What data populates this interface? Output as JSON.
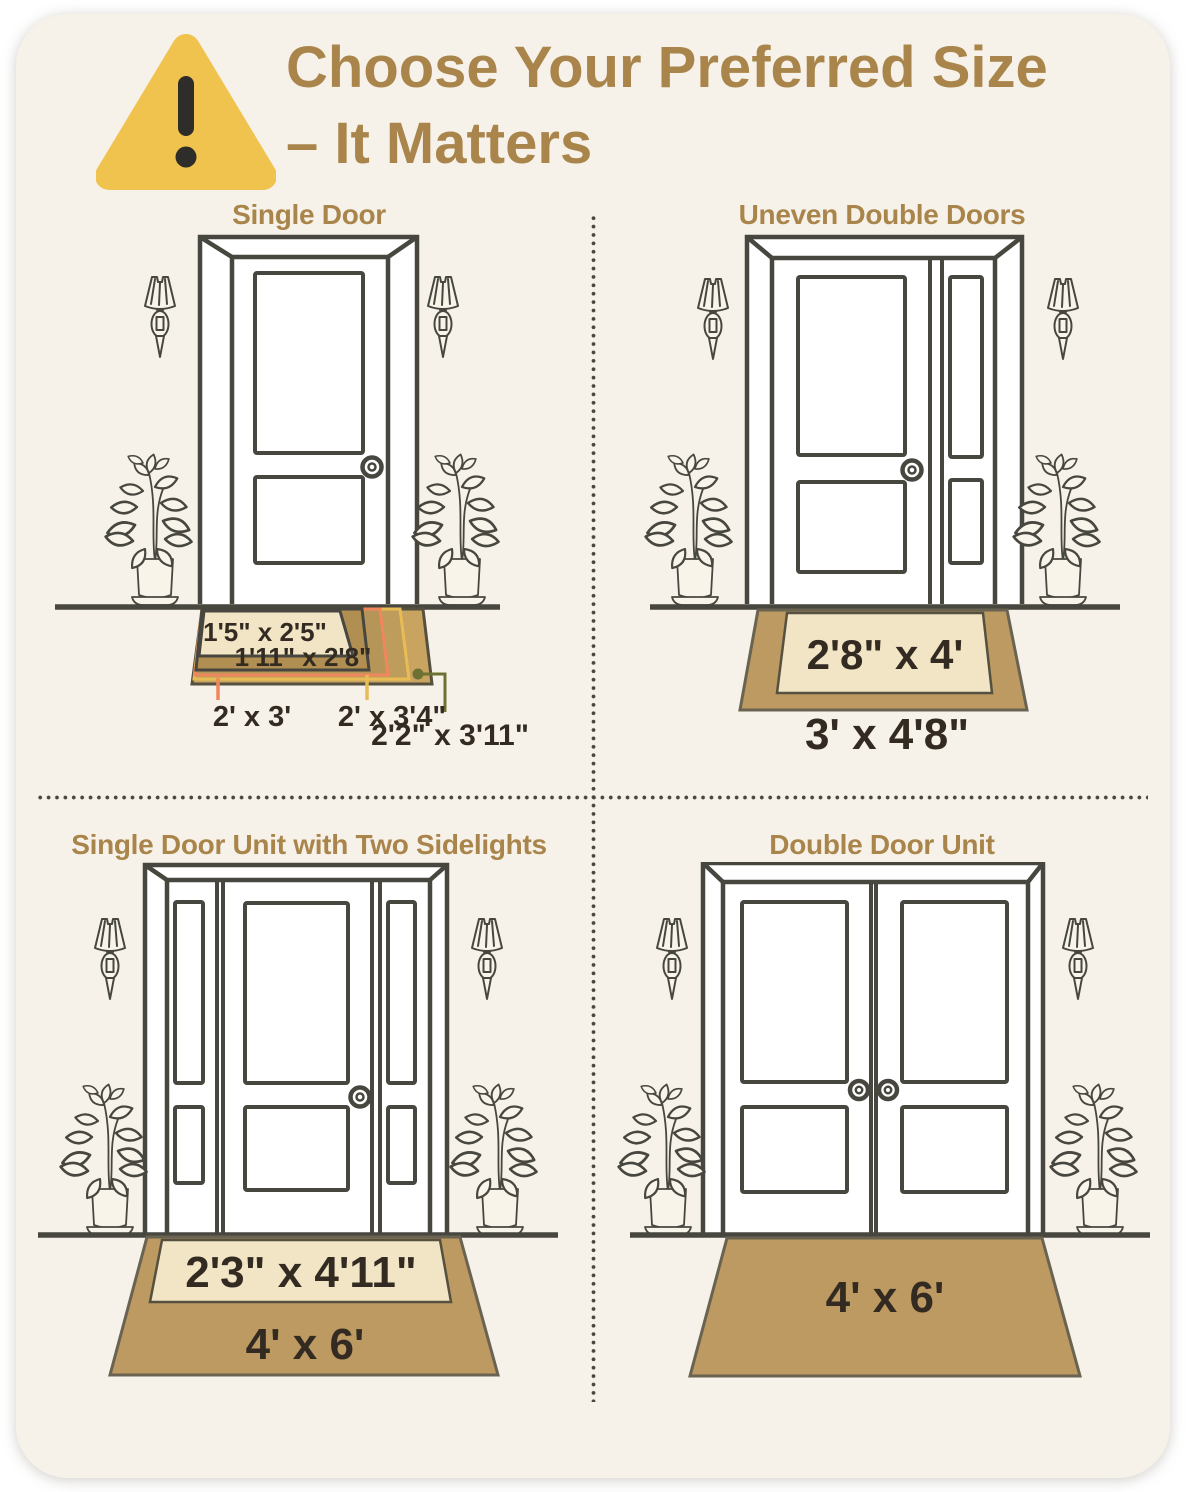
{
  "header": {
    "icon": "warning-triangle",
    "title_line1": "Choose Your Preferred Size",
    "title_line2": "– It Matters"
  },
  "quadrants": [
    {
      "id": "single-door",
      "label": "Single Door",
      "mats": [
        "1'5\" x 2'5\"",
        "1'11\" x 2'8\"",
        "2' x 3'",
        "2' x 3'4\"",
        "2'2\" x 3'11\""
      ]
    },
    {
      "id": "uneven-double-doors",
      "label": "Uneven Double Doors",
      "mats": [
        "2'8\" x 4'",
        "3' x 4'8\""
      ]
    },
    {
      "id": "single-door-two-sidelights",
      "label": "Single Door Unit with Two Sidelights",
      "mats": [
        "2'3\" x 4'11\"",
        "4' x 6'"
      ]
    },
    {
      "id": "double-door-unit",
      "label": "Double Door Unit",
      "mats": [
        "4' x 6'"
      ]
    }
  ],
  "colors": {
    "card_bg": "#F7F2E9",
    "title_text": "#A9854B",
    "line_art": "#474740",
    "mat_tan": "#BC9A62",
    "mat_tan_dark": "#B18E51",
    "mat_gold": "#C9A360",
    "mat_cream": "#F1E5C6",
    "mat_label_text": "#332B21",
    "accent_orange": "#F0875C",
    "accent_yellow": "#E8BC55",
    "accent_olive": "#6D7233",
    "warning_triangle": "#F0C24E",
    "warning_mark": "#2E2D29",
    "divider_dots": "#4B453B"
  }
}
